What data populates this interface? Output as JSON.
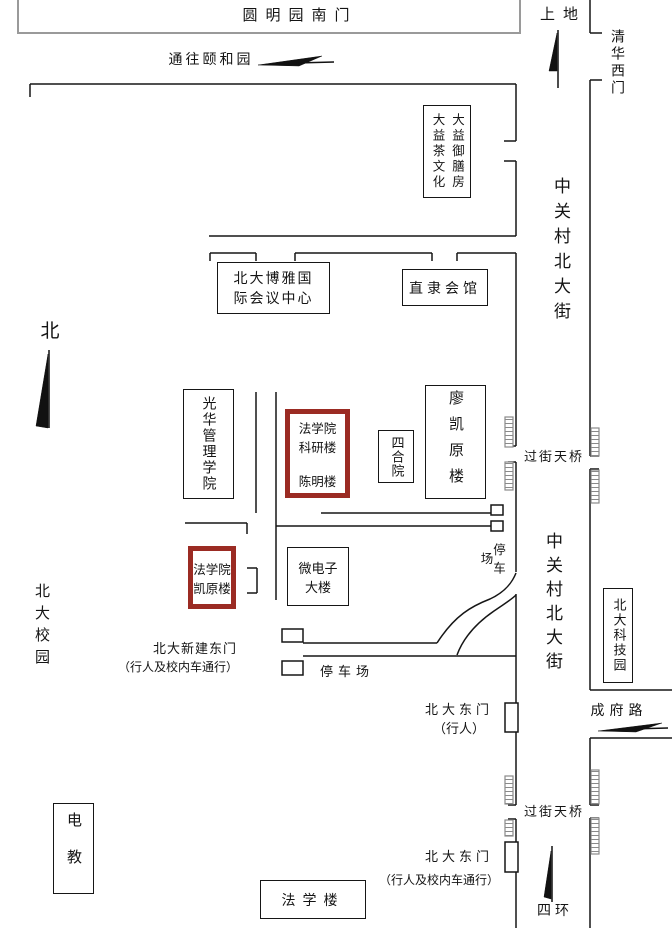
{
  "colors": {
    "highlight": "#9B2B23",
    "line": "#161616",
    "gray": "#9a9a9a"
  },
  "map": {
    "yuanmingyuan_gate": "圆明园南门",
    "to_summer_palace": "通往颐和园",
    "shangdi": "上地",
    "qinghua_west_gate": "清华西门",
    "street_name": "中关村北大街",
    "dayi_col_left": "大益茶文化",
    "dayi_col_right": "大益御膳房",
    "boya_line1": "北大博雅国",
    "boya_line2": "际会议中心",
    "zhili_hall": "直隶会馆",
    "north": "北",
    "guanghua": "光华管理学院",
    "law_research_1": "法学院",
    "law_research_2": "科研楼",
    "law_research_3": "陈明楼",
    "siheyuan": "四合院",
    "liao_kaiyuan": "廖凯原楼",
    "overpass": "过街天桥",
    "parking": "停车场",
    "law_kaiyuan_1": "法学院",
    "law_kaiyuan_2": "凯原楼",
    "micro_1": "微电子",
    "micro_2": "大楼",
    "new_east_gate": "北大新建东门",
    "vehicle_note": "（行人及校内车通行）",
    "pku_campus": "北大校园",
    "east_gate": "北大东门",
    "pedestrian_note": "（行人）",
    "chengfu_road": "成府路",
    "sci_park": "北大科技园",
    "dianjiao": "电教",
    "law_building": "法学楼",
    "fourth_ring": "四环"
  }
}
